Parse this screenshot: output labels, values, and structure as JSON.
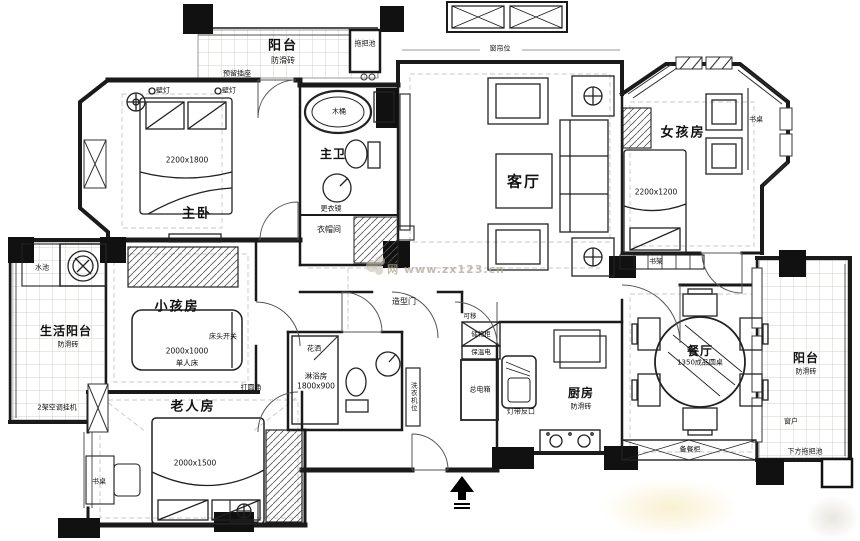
{
  "watermark": {
    "site": "网 www.zx123.cn"
  },
  "rooms": {
    "balcony_top": {
      "name": "阳台",
      "tile": "防滑砖",
      "mop_pool": "拖把池",
      "socket": "预留插座"
    },
    "master_bedroom": {
      "name": "主卧",
      "bed_size": "2200x1800",
      "lamp_left": "壁灯",
      "lamp_right": "壁灯"
    },
    "master_bath": {
      "name": "主卫",
      "tub": "木桶"
    },
    "cloakroom": {
      "name": "衣帽间",
      "mirror": "更衣镜"
    },
    "living_room": {
      "name": "客厅",
      "curtain": "窗帘位"
    },
    "girl_room": {
      "name": "女孩房",
      "bed_size": "2200x1200",
      "desk": "书桌",
      "bookshelf": "书架"
    },
    "utility_balcony": {
      "name": "生活阳台",
      "tile": "防滑砖",
      "sink": "水池",
      "ac_units": "2架空调挂机"
    },
    "kid_room": {
      "name": "小孩房",
      "bed_size": "2000x1000",
      "bed_type": "单人床",
      "switch": "床头开关",
      "corner": "打圆角"
    },
    "elder_room": {
      "name": "老人房",
      "bed_size": "2000x1500",
      "desk": "书桌"
    },
    "bathroom2": {
      "name": "淋浴房",
      "size": "1800x900",
      "shower_head": "花洒",
      "cabinet": "洗衣机位"
    },
    "hallway": {
      "styled_door": "造型门",
      "movable": "可移"
    },
    "kitchen": {
      "name": "厨房",
      "tile": "防滑砖",
      "storage": "储物柜",
      "warmer": "保温电",
      "power_box": "总电箱",
      "light_trough": "灯带反口"
    },
    "dining_room": {
      "name": "餐厅",
      "table": "1350成品圆桌",
      "sideboard": "备餐柜"
    },
    "balcony_right": {
      "name": "阳台",
      "tile": "防滑砖",
      "window": "窗户",
      "mop_pool": "下方拖把池"
    }
  }
}
